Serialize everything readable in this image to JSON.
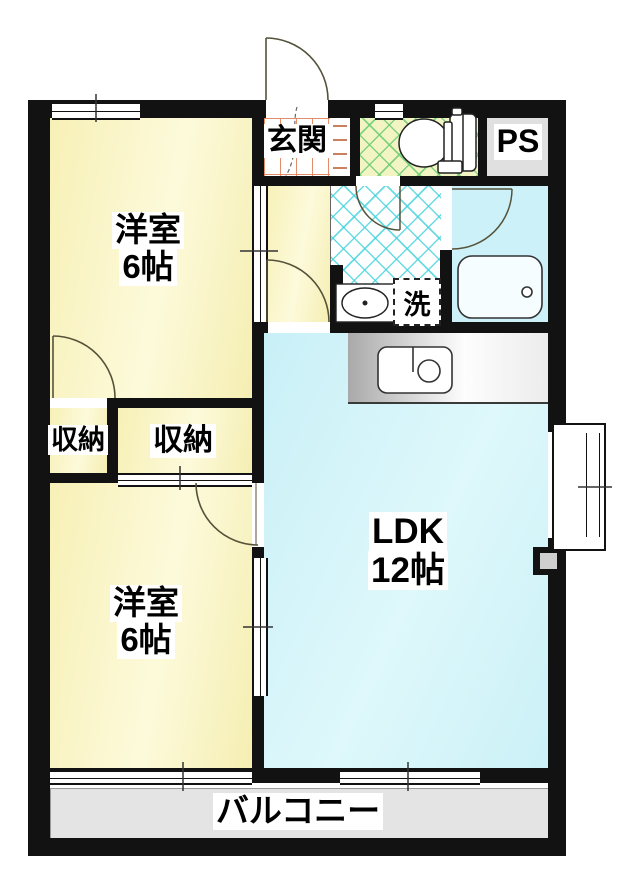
{
  "rooms": {
    "genkan": {
      "label": "玄関"
    },
    "ps": {
      "label": "PS"
    },
    "western_room_1": {
      "name": "洋室",
      "size": "6帖"
    },
    "western_room_2": {
      "name": "洋室",
      "size": "6帖"
    },
    "closet_left": {
      "label": "収納"
    },
    "closet_right": {
      "label": "収納"
    },
    "laundry": {
      "label": "洗"
    },
    "ldk": {
      "name": "LDK",
      "size": "12帖"
    },
    "balcony": {
      "label": "バルコニー"
    }
  },
  "fixtures": [
    "toilet",
    "bathtub",
    "kitchen-sink",
    "washbasin",
    "washing-machine-space"
  ],
  "colors": {
    "wall_black": "#121212",
    "room_yellow": "#faf5c6",
    "ldk_cyan": "#d2f3f8",
    "bath_cyan": "#cdf1f8",
    "toilet_green_bg": "#f2f4c4",
    "toilet_grid_green": "#6ecd73",
    "wash_grid_cyan": "#42d2dc",
    "genkan_tile_orange": "#e0825a",
    "balcony_gray": "#e4e4e4",
    "ps_gray": "#e0e0e0"
  }
}
